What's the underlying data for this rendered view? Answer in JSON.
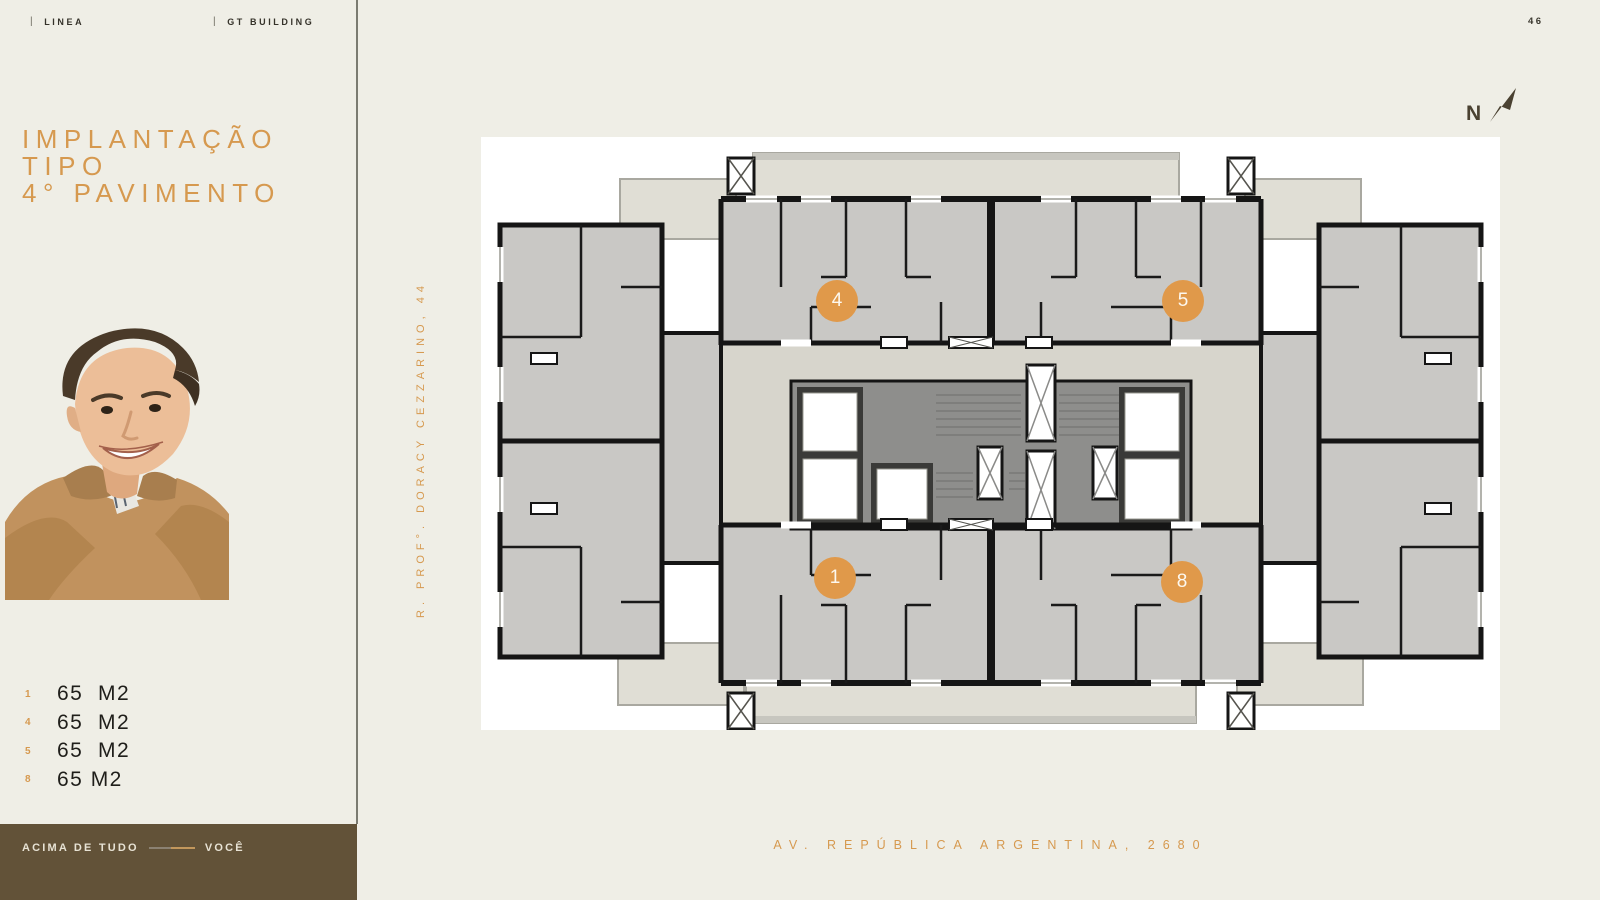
{
  "header": {
    "brand_left": "LINEA",
    "brand_right": "GT BUILDING",
    "page_number": "46"
  },
  "sidebar": {
    "title_lines": [
      "IMPLANTAÇÃO",
      "TIPO",
      "4° PAVIMENTO"
    ],
    "units": [
      {
        "num": "1",
        "area": "65  M2"
      },
      {
        "num": "4",
        "area": "65  M2"
      },
      {
        "num": "5",
        "area": "65  M2"
      },
      {
        "num": "8",
        "area": "65 M2"
      }
    ],
    "footer": {
      "tagline_left": "ACIMA DE TUDO",
      "tagline_right": "VOCÊ"
    }
  },
  "plan": {
    "street_left": "R. PROF°. DORACY CEZZARINO, 44",
    "street_bottom": "AV. REPÚBLICA ARGENTINA, 2680",
    "north_label": "N",
    "markers": [
      {
        "label": "4"
      },
      {
        "label": "5"
      },
      {
        "label": "1"
      },
      {
        "label": "8"
      }
    ]
  },
  "colors": {
    "accent_orange": "#D6994F",
    "marker_orange": "#E0994A",
    "footer_brown": "#625238",
    "background_cream": "#EFEEE6"
  }
}
